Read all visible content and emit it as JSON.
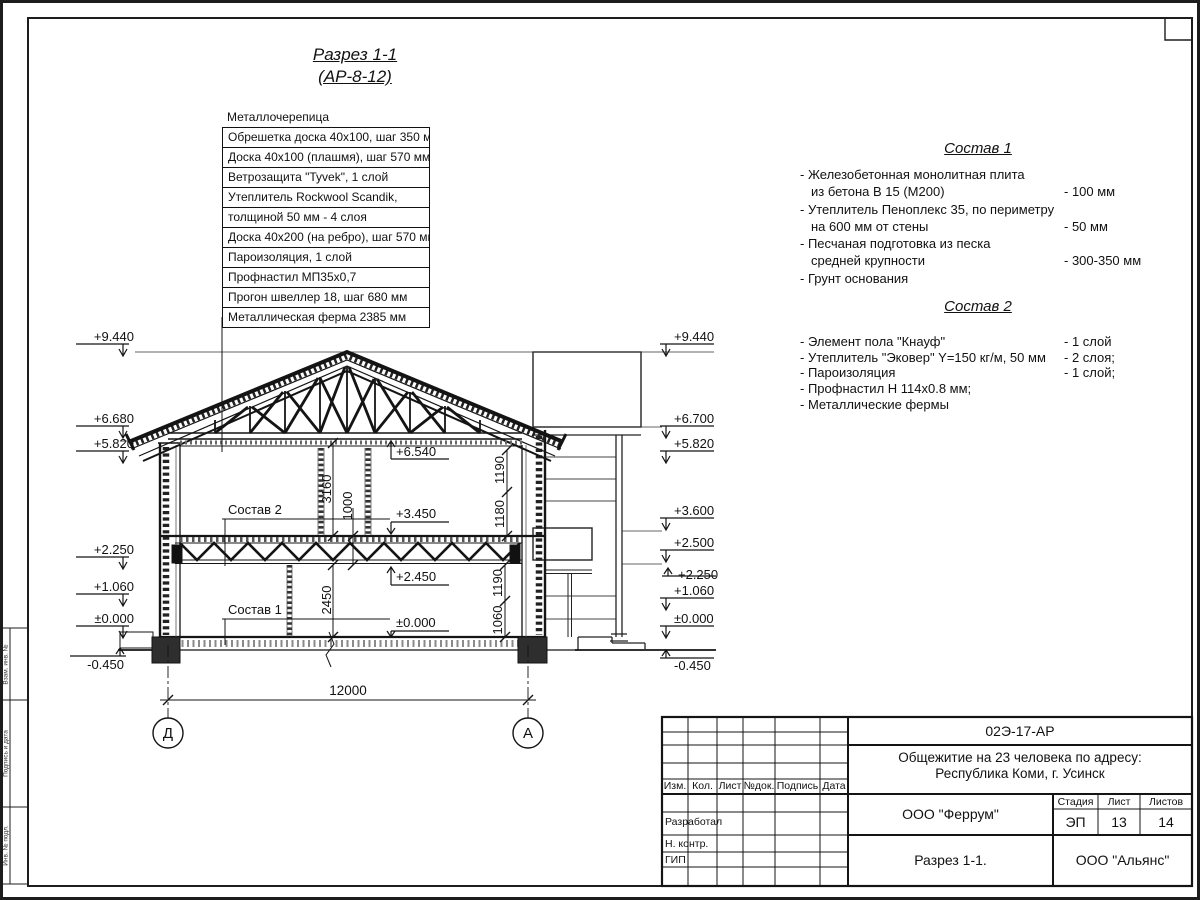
{
  "title": {
    "line1": "Разрез 1-1",
    "line2": "(АР-8-12)"
  },
  "roof_callout": {
    "rows": [
      "Металлочерепица",
      "Обрешетка доска 40х100, шаг 350 мм",
      "Доска 40х100 (плашмя), шаг 570 мм",
      "Ветрозащита \"Tyvek\", 1 слой",
      "Утеплитель Rockwool Scandik,",
      "толщиной 50 мм - 4 слоя",
      "Доска 40х200 (на ребро), шаг 570 мм",
      "Пароизоляция, 1 слой",
      "Профнастил МП35х0,7",
      "Прогон швеллер 18, шаг 680 мм",
      "Металлическая ферма 2385 мм"
    ]
  },
  "sostav1": {
    "heading": "Состав 1",
    "lines": [
      {
        "t": "- Железобетонная  монолитная плита",
        "v": ""
      },
      {
        "t": "из бетона В 15 (М200)",
        "v": "- 100 мм"
      },
      {
        "t": "- Утеплитель Пеноплекс 35, по периметру",
        "v": ""
      },
      {
        "t": "на 600 мм от стены",
        "v": "- 50 мм"
      },
      {
        "t": "- Песчаная подготовка из песка",
        "v": ""
      },
      {
        "t": "средней крупности",
        "v": "- 300-350 мм"
      },
      {
        "t": "- Грунт основания",
        "v": ""
      }
    ]
  },
  "sostav2": {
    "heading": "Состав 2",
    "lines": [
      {
        "t": "- Элемент пола \"Кнауф\"",
        "v": "- 1 слой"
      },
      {
        "t": "- Утеплитель \"Эковер\" Y=150 кг/м, 50 мм",
        "v": "- 2 слоя;"
      },
      {
        "t": "- Пароизоляция",
        "v": "- 1 слой;"
      },
      {
        "t": "- Профнастил Н 114х0.8 мм;",
        "v": ""
      },
      {
        "t": "- Металлические фермы",
        "v": ""
      }
    ]
  },
  "marks_left": [
    "+9.440",
    "+6.680",
    "+5.820",
    "+2.250",
    "+1.060",
    "±0.000",
    "-0.450"
  ],
  "marks_right": [
    "+9.440",
    "+6.700",
    "+5.820",
    "+3.600",
    "+2.500",
    "+2.250",
    "+1.060",
    "±0.000",
    "-0.450"
  ],
  "levels_internal": [
    "+6.540",
    "+3.450",
    "+2.450",
    "±0.000"
  ],
  "section_refs": {
    "s2": "Состав 2",
    "s1": "Состав 1"
  },
  "dims": {
    "overall": "12000",
    "floor2_height": "3160",
    "truss_height": "1000",
    "floor1_height": "2450",
    "right_upper": [
      "1190",
      "1180"
    ],
    "right_lower": [
      "1190",
      "1060"
    ]
  },
  "axes": {
    "left": "Д",
    "right": "А"
  },
  "frame_stamp": [
    "Взам. инв. №",
    "Подпись и дата",
    "Инв. № подл."
  ],
  "titleblock": {
    "doc_code": "02Э-17-АР",
    "project_line1": "Общежитие на 23 человека по адресу:",
    "project_line2": "Республика Коми, г. Усинск",
    "cols": [
      "Изм.",
      "Кол.",
      "Лист",
      "№док.",
      "Подпись",
      "Дата"
    ],
    "roles": [
      "Разработал",
      "Н. контр.",
      "ГИП"
    ],
    "org": "ООО \"Феррум\"",
    "stage_label": "Стадия",
    "sheet_label": "Лист",
    "sheets_label": "Листов",
    "stage": "ЭП",
    "sheet": "13",
    "sheets": "14",
    "drawing_name": "Разрез 1-1.",
    "contractor": "ООО \"Альянс\""
  }
}
